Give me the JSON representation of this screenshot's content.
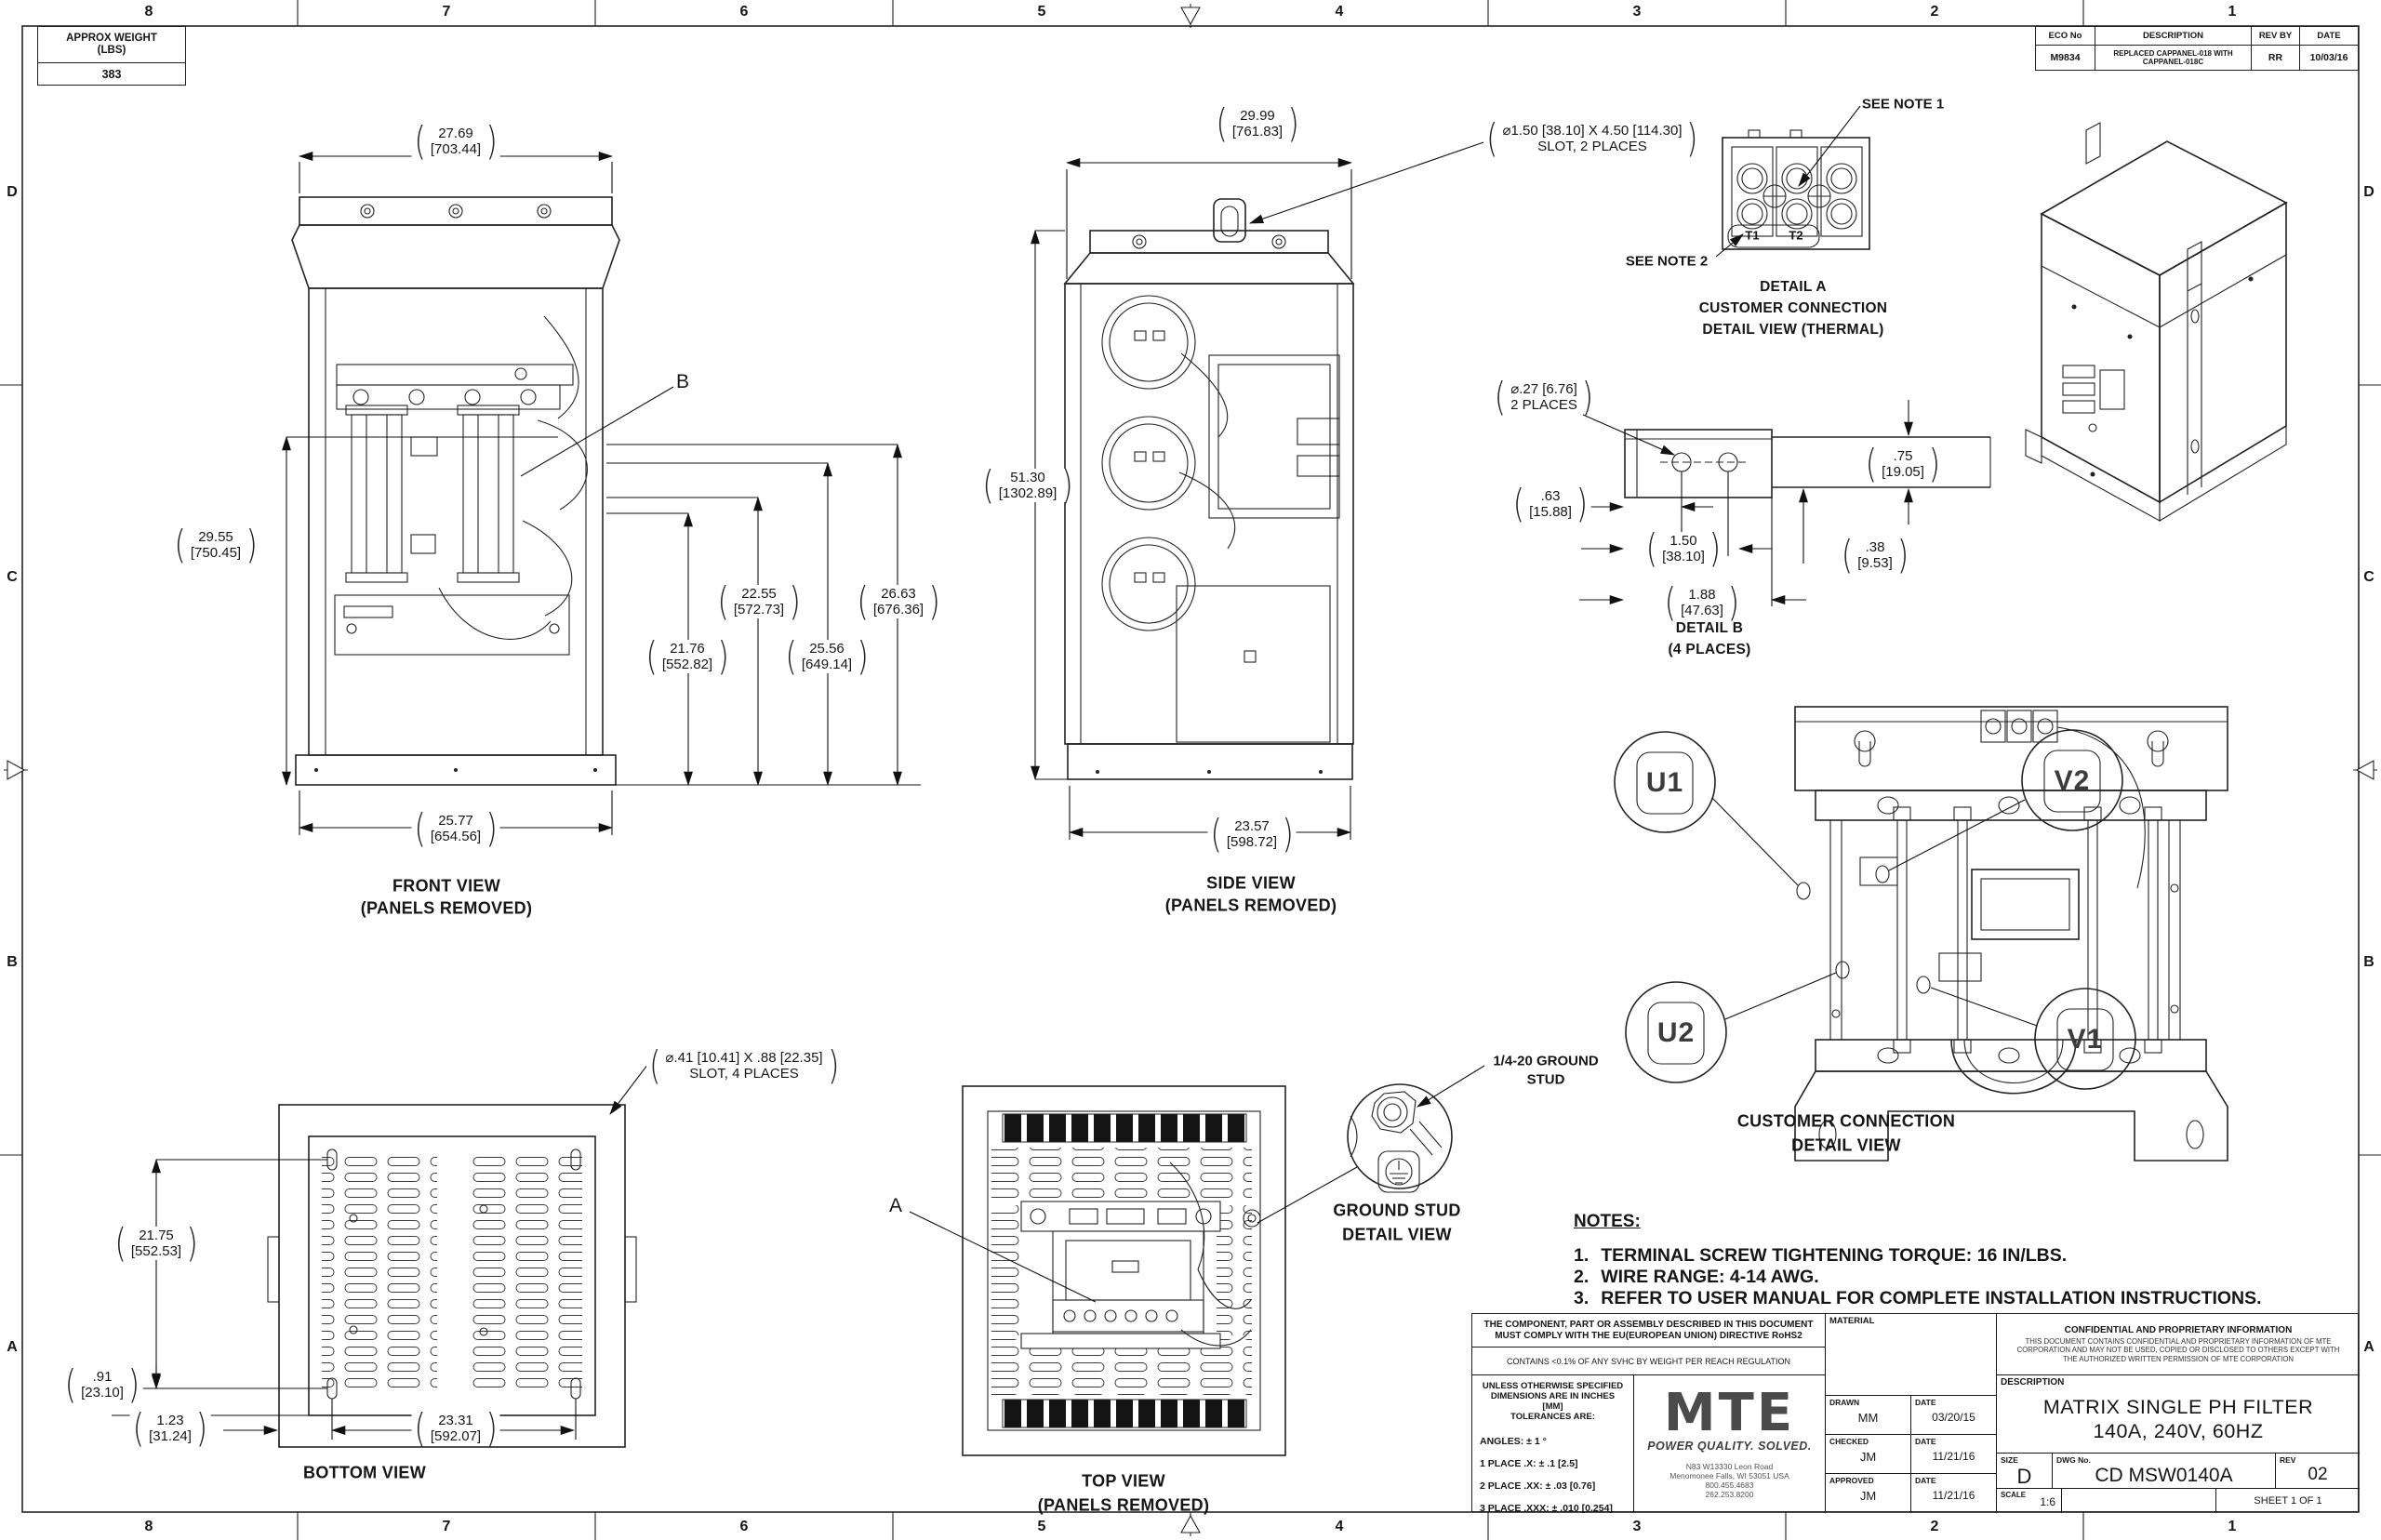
{
  "border": {
    "cols": [
      "8",
      "7",
      "6",
      "5",
      "4",
      "3",
      "2",
      "1"
    ],
    "rows": [
      "D",
      "C",
      "B",
      "A"
    ]
  },
  "weight_box": {
    "title_line1": "APPROX WEIGHT",
    "title_line2": "(LBS)",
    "value": "383"
  },
  "eco_table": {
    "headers": [
      "ECO No",
      "DESCRIPTION",
      "REV BY",
      "DATE"
    ],
    "eco_no": "M9834",
    "description": "REPLACED CAPPANEL-018 WITH CAPPANEL-018C",
    "rev_by": "RR",
    "date": "10/03/16"
  },
  "front_view": {
    "caption_line1": "FRONT VIEW",
    "caption_line2": "(PANELS REMOVED)",
    "label_b": "B",
    "dim_width": {
      "in": "27.69",
      "mm": "[703.44]"
    },
    "dim_height": {
      "in": "29.55",
      "mm": "[750.45]"
    },
    "dim_t1": {
      "in": "22.55",
      "mm": "[572.73]"
    },
    "dim_t2": {
      "in": "21.76",
      "mm": "[552.82]"
    },
    "dim_t3": {
      "in": "26.63",
      "mm": "[676.36]"
    },
    "dim_t4": {
      "in": "25.56",
      "mm": "[649.14]"
    },
    "dim_base": {
      "in": "25.77",
      "mm": "[654.56]"
    }
  },
  "side_view": {
    "caption_line1": "SIDE VIEW",
    "caption_line2": "(PANELS REMOVED)",
    "slot_note_line1": "⌀1.50 [38.10]  X 4.50 [114.30]",
    "slot_note_line2": "SLOT, 2 PLACES",
    "dim_width": {
      "in": "29.99",
      "mm": "[761.83]"
    },
    "dim_height": {
      "in": "51.30",
      "mm": "[1302.89]"
    },
    "dim_base": {
      "in": "23.57",
      "mm": "[598.72]"
    }
  },
  "detail_a": {
    "see_note_1": "SEE NOTE 1",
    "see_note_2": "SEE NOTE 2",
    "t1": "T1",
    "t2": "T2",
    "caption_line1": "DETAIL A",
    "caption_line2": "CUSTOMER CONNECTION",
    "caption_line3": "DETAIL VIEW (THERMAL)"
  },
  "detail_b": {
    "hole_note_line1": "⌀.27 [6.76]",
    "hole_note_line2": "2 PLACES",
    "dim_lip": {
      "in": ".63",
      "mm": "[15.88]"
    },
    "dim_spacing": {
      "in": "1.50",
      "mm": "[38.10]"
    },
    "dim_length": {
      "in": "1.88",
      "mm": "[47.63]"
    },
    "dim_bar": {
      "in": ".75",
      "mm": "[19.05]"
    },
    "dim_offset": {
      "in": ".38",
      "mm": "[9.53]"
    },
    "caption_line1": "DETAIL B",
    "caption_line2": "(4 PLACES)"
  },
  "customer_connection": {
    "balloon_u1": "U1",
    "balloon_v2": "V2",
    "balloon_u2": "U2",
    "balloon_v1": "V1",
    "caption_line1": "CUSTOMER CONNECTION",
    "caption_line2": "DETAIL VIEW"
  },
  "bottom_view": {
    "slot_note_line1": "⌀.41 [10.41]  X .88 [22.35]",
    "slot_note_line2": "SLOT, 4 PLACES",
    "dim_height": {
      "in": "21.75",
      "mm": "[552.53]"
    },
    "dim_offset_v": {
      "in": ".91",
      "mm": "[23.10]"
    },
    "dim_offset_h": {
      "in": "1.23",
      "mm": "[31.24]"
    },
    "dim_width": {
      "in": "23.31",
      "mm": "[592.07]"
    },
    "caption": "BOTTOM VIEW"
  },
  "top_view": {
    "label_a": "A",
    "caption_line1": "TOP VIEW",
    "caption_line2": "(PANELS REMOVED)"
  },
  "ground_stud": {
    "callout_line1": "1/4-20 GROUND",
    "callout_line2": "STUD",
    "caption_line1": "GROUND STUD",
    "caption_line2": "DETAIL VIEW"
  },
  "notes": {
    "heading": "NOTES:",
    "item1_num": "1.",
    "item1": "TERMINAL SCREW TIGHTENING TORQUE: 16 IN/LBS.",
    "item2_num": "2.",
    "item2": "WIRE RANGE: 4-14 AWG.",
    "item3_num": "3.",
    "item3": "REFER TO USER MANUAL FOR COMPLETE INSTALLATION INSTRUCTIONS."
  },
  "title_block": {
    "compliance_line1": "THE COMPONENT, PART OR ASSEMBLY DESCRIBED IN THIS DOCUMENT",
    "compliance_line2": "MUST COMPLY WITH THE EU(EUROPEAN UNION) DIRECTIVE RoHS2",
    "reach": "CONTAINS <0.1% OF ANY SVHC BY WEIGHT PER REACH REGULATION",
    "tolerance_header_line1": "UNLESS OTHERWISE SPECIFIED",
    "tolerance_header_line2": "DIMENSIONS ARE IN INCHES [MM]",
    "tolerance_header_line3": "TOLERANCES ARE:",
    "tol_angles": "ANGLES: ± 1 °",
    "tol_1place": "1 PLACE .X: ± .1 [2.5]",
    "tol_2place": "2 PLACE .XX: ± .03 [0.76]",
    "tol_3place": "3 PLACE .XXX: ± .010 [0.254]",
    "logo_text": "MTE",
    "logo_tagline": "POWER QUALITY. SOLVED.",
    "address_line1": "N83 W13330 Leon Road",
    "address_line2": "Menomonee Falls, WI 53051 USA",
    "address_line3": "800.455.4683",
    "address_line4": "262.253.8200",
    "material_label": "MATERIAL",
    "drawn_label": "DRAWN",
    "drawn_value": "MM",
    "drawn_date_label": "DATE",
    "drawn_date": "03/20/15",
    "checked_label": "CHECKED",
    "checked_value": "JM",
    "checked_date_label": "DATE",
    "checked_date": "11/21/16",
    "approved_label": "APPROVED",
    "approved_value": "JM",
    "approved_date_label": "DATE",
    "approved_date": "11/21/16",
    "confidential_title": "CONFIDENTIAL AND PROPRIETARY INFORMATION",
    "confidential_body": "THIS DOCUMENT CONTAINS CONFIDENTIAL AND PROPRIETARY INFORMATION OF MTE CORPORATION AND MAY NOT BE USED, COPIED OR DISCLOSED TO OTHERS EXCEPT WITH THE AUTHORIZED WRITTEN PERMISSION OF MTE CORPORATION",
    "description_label": "DESCRIPTION",
    "description_line1": "MATRIX SINGLE PH FILTER",
    "description_line2": "140A, 240V, 60HZ",
    "size_label": "SIZE",
    "size_value": "D",
    "dwg_label": "DWG No.",
    "dwg_value": "CD MSW0140A",
    "rev_label": "REV",
    "rev_value": "02",
    "scale_label": "SCALE",
    "scale_value": "1:6",
    "sheet_value": "SHEET 1  OF 1"
  }
}
